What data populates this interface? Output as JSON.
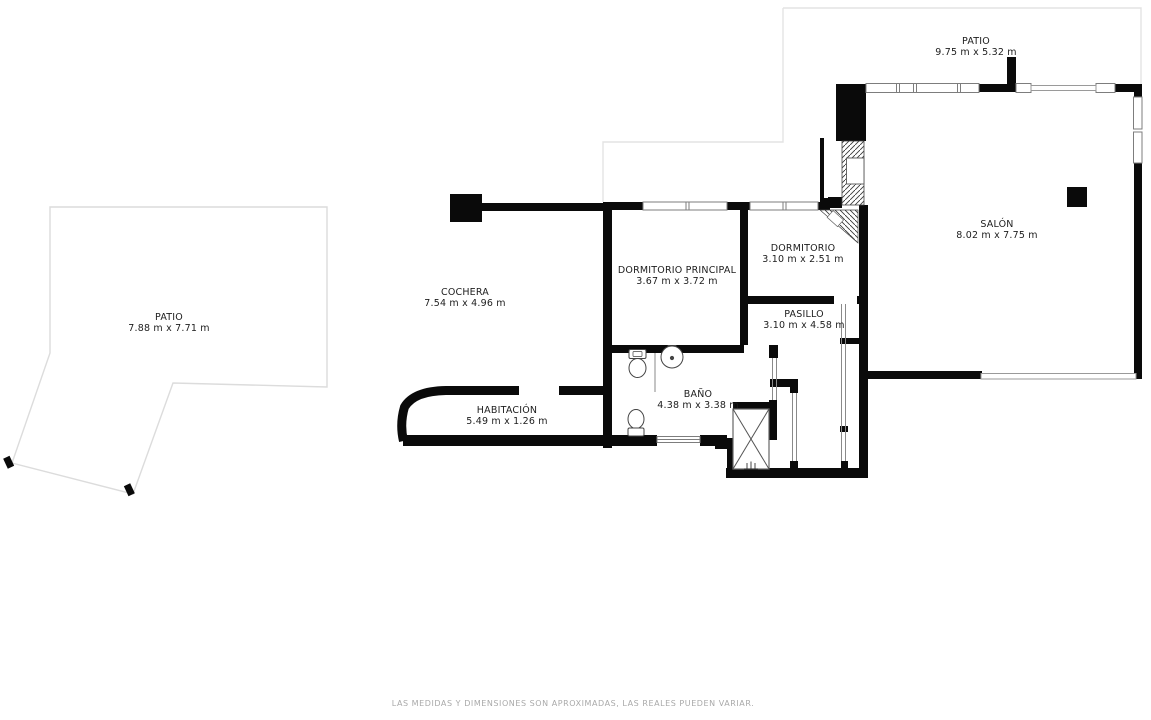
{
  "rooms": [
    {
      "name": "PATIO",
      "dims": "9.75 m x 5.32 m"
    },
    {
      "name": "SALÓN",
      "dims": "8.02 m x 7.75 m"
    },
    {
      "name": "DORMITORIO",
      "dims": "3.10 m x 2.51 m"
    },
    {
      "name": "DORMITORIO PRINCIPAL",
      "dims": "3.67 m x 3.72 m"
    },
    {
      "name": "PASILLO",
      "dims": "3.10 m x 4.58 m"
    },
    {
      "name": "COCHERA",
      "dims": "7.54 m x 4.96 m"
    },
    {
      "name": "PATIO",
      "dims": "7.88 m x 7.71 m"
    },
    {
      "name": "BAÑO",
      "dims": "4.38 m x 3.38 m"
    },
    {
      "name": "HABITACIÓN",
      "dims": "5.49 m x 1.26 m"
    }
  ],
  "footer": {
    "disclaimer": "LAS MEDIDAS Y DIMENSIONES SON APROXIMADAS, LAS REALES PUEDEN VARIAR."
  },
  "icons": [
    "toilet-icon",
    "sink-icon",
    "shower-icon",
    "entry-steps-icon"
  ],
  "colors": {
    "wall": "#0a0a0a",
    "background": "#ffffff",
    "patio_outline": "#dfdfdf",
    "window_stroke": "#7d7d7d",
    "label_text": "#1d1d1d",
    "disclaimer_text": "#a9a9a9"
  }
}
